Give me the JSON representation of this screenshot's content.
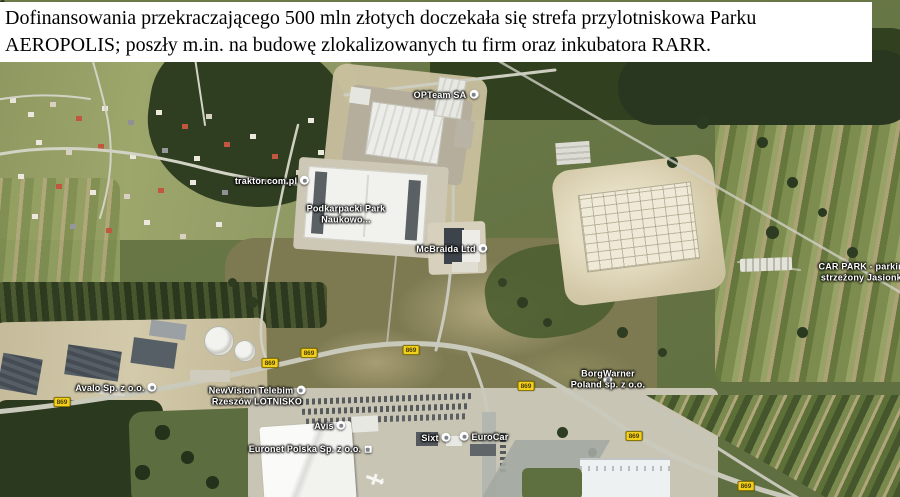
{
  "caption": {
    "line1": "Dofinansowania przekraczającego 500 mln złotych doczekała się strefa przylotniskowa Parku",
    "line2": "AEROPOLIS; poszły m.in. na budowę zlokalizowanych tu firm oraz inkubatora RARR."
  },
  "map": {
    "provider": "satellite",
    "badge_color": "#f2cf1d",
    "badge_text_color": "#4a3c00",
    "poi_labels": [
      {
        "name": "opteam",
        "lines": [
          "OPTeam SA"
        ],
        "marker": "right",
        "x": 446,
        "y": 95
      },
      {
        "name": "traktor",
        "lines": [
          "traktor.com.pl"
        ],
        "marker": "right",
        "x": 272,
        "y": 181
      },
      {
        "name": "podkarpacki-park",
        "lines": [
          "Podkarpacki Park",
          "Naukowo..."
        ],
        "marker": "none",
        "x": 346,
        "y": 214
      },
      {
        "name": "mcbraida",
        "lines": [
          "McBraida Ltd"
        ],
        "marker": "right",
        "x": 452,
        "y": 249
      },
      {
        "name": "car-park",
        "lines": [
          "CAR PARK - parking",
          "strzeżony Jasionka"
        ],
        "marker": "none",
        "x": 864,
        "y": 272
      },
      {
        "name": "avalo",
        "lines": [
          "Avalo Sp. z o.o."
        ],
        "marker": "right",
        "x": 116,
        "y": 388
      },
      {
        "name": "new-vision",
        "lines": [
          "NewVision Telebim",
          "Rzeszów LOTNISKO"
        ],
        "marker": "right",
        "x": 257,
        "y": 396
      },
      {
        "name": "borgwarner",
        "lines": [
          "BorgWarner",
          "Poland sp. z o.o."
        ],
        "marker": "mid",
        "x": 608,
        "y": 379
      },
      {
        "name": "avis",
        "lines": [
          "Avis"
        ],
        "marker": "right",
        "x": 330,
        "y": 426
      },
      {
        "name": "sixt",
        "lines": [
          "Sixt"
        ],
        "marker": "right",
        "x": 436,
        "y": 438
      },
      {
        "name": "eurocar",
        "lines": [
          "EuroCar"
        ],
        "marker": "left",
        "x": 484,
        "y": 437
      },
      {
        "name": "euronet",
        "lines": [
          "Euronet Polska Sp. z o.o."
        ],
        "marker": "right-square",
        "x": 310,
        "y": 449
      }
    ],
    "road_badges": [
      {
        "text": "869",
        "x": 62,
        "y": 402
      },
      {
        "text": "869",
        "x": 270,
        "y": 363
      },
      {
        "text": "869",
        "x": 309,
        "y": 353
      },
      {
        "text": "869",
        "x": 411,
        "y": 350
      },
      {
        "text": "869",
        "x": 526,
        "y": 386
      },
      {
        "text": "869",
        "x": 634,
        "y": 436
      },
      {
        "text": "869",
        "x": 746,
        "y": 486
      }
    ]
  }
}
